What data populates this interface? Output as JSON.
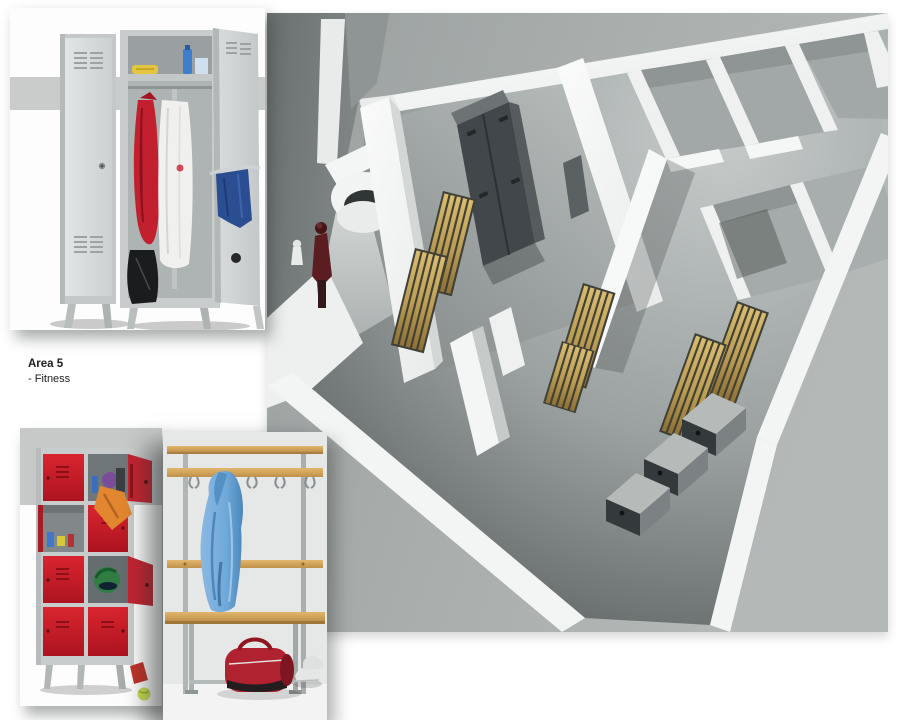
{
  "label": {
    "title": "Area 5",
    "subtitle": "- Fitness"
  },
  "figures": {
    "top_photo": {
      "name": "wardrobe-lockers-photo",
      "alt": "Two grey single changing-room lockers on tapered legs, right one open with red jacket, white coat, blue towel and black bag"
    },
    "red_lockers": {
      "name": "multi-compartment-lockers-photo",
      "alt": "Eight-compartment locker unit with red doors, several open showing bottles, orange towel and a green helmet; tennis ball beside"
    },
    "bench": {
      "name": "changing-bench-photo",
      "alt": "Changing-room bench with top shelf, coat-hook rail, hanging blue bathrobe, red sports bag and trainers"
    },
    "render": {
      "name": "area-5-floor-plan-render",
      "alt": "Aerial 3D render of the Area 5 fitness changing area: white walls, grey lockers, wooden slat benches, shower cubicles and a person at the entrance"
    }
  },
  "palette": {
    "page_bg": "#ffffff",
    "render_bg": "#a9aead",
    "wall_white": "#f2f4f3",
    "floor_dark": "#4a5150",
    "bench_wood": "#c3a45a",
    "locker_dark": "#41474a",
    "locker_red": "#d2232f",
    "locker_grey": "#d2d5d6",
    "photo_band_grey": "#c9cccb",
    "robe_blue": "#6fa9d9",
    "bag_red": "#b02230",
    "figure_red": "#5c1d22"
  }
}
